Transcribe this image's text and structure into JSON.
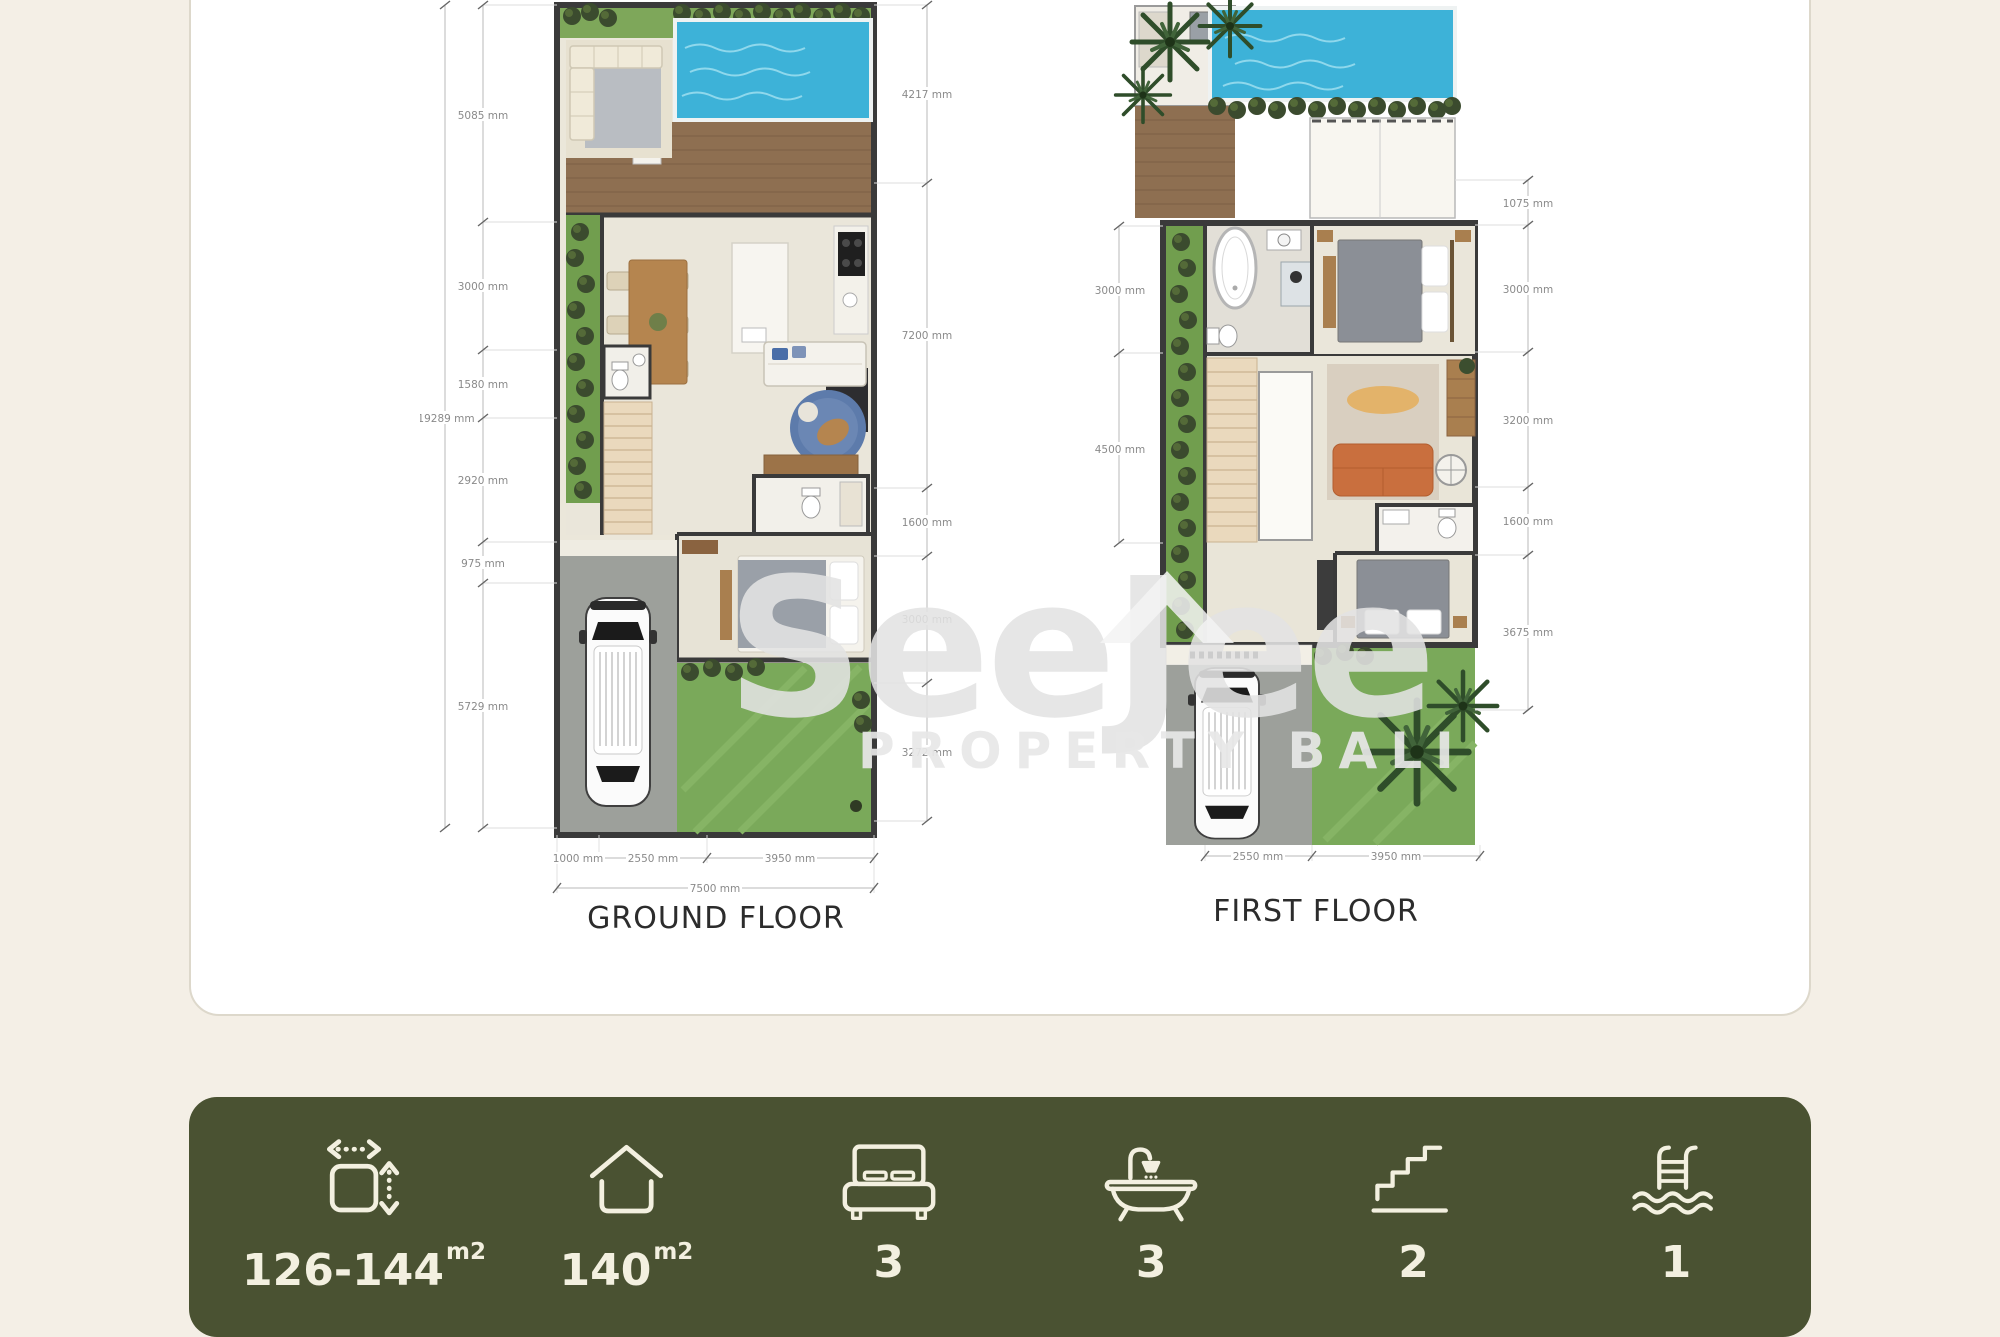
{
  "watermark": {
    "brand": "SeeJee",
    "subtitle": "PROPERTY BALI"
  },
  "plans": {
    "ground": {
      "title": "GROUND FLOOR",
      "total_height": "19289 mm",
      "left_dims": [
        "5085 mm",
        "3000 mm",
        "1580 mm",
        "2920 mm",
        "975 mm",
        "5729 mm"
      ],
      "right_dims": [
        "4217 mm",
        "7200 mm",
        "1600 mm",
        "3000 mm",
        "3272 mm"
      ],
      "bottom_dims": [
        "1000 mm",
        "2550 mm",
        "3950 mm"
      ],
      "total_width": "7500 mm"
    },
    "first": {
      "title": "FIRST FLOOR",
      "left_dims": [
        "3000 mm",
        "4500 mm"
      ],
      "right_dims": [
        "1075 mm",
        "3000 mm",
        "3200 mm",
        "1600 mm",
        "3675 mm"
      ],
      "bottom_dims": [
        "2550 mm",
        "3950 mm"
      ]
    }
  },
  "stats": {
    "land": {
      "label": "land-size",
      "value": "126-144",
      "unit": "m2"
    },
    "building": {
      "label": "building-size",
      "value": "140",
      "unit": "m2"
    },
    "bedrooms": {
      "label": "bedrooms",
      "value": "3"
    },
    "bathrooms": {
      "label": "bathrooms",
      "value": "3"
    },
    "floors": {
      "label": "floors",
      "value": "2"
    },
    "pools": {
      "label": "pools",
      "value": "1"
    }
  },
  "colors": {
    "page_bg": "#f4efe6",
    "stats_bar_bg": "#4a5232",
    "stats_bar_text": "#f3f0e0",
    "pool_water": "#3db2d8"
  }
}
